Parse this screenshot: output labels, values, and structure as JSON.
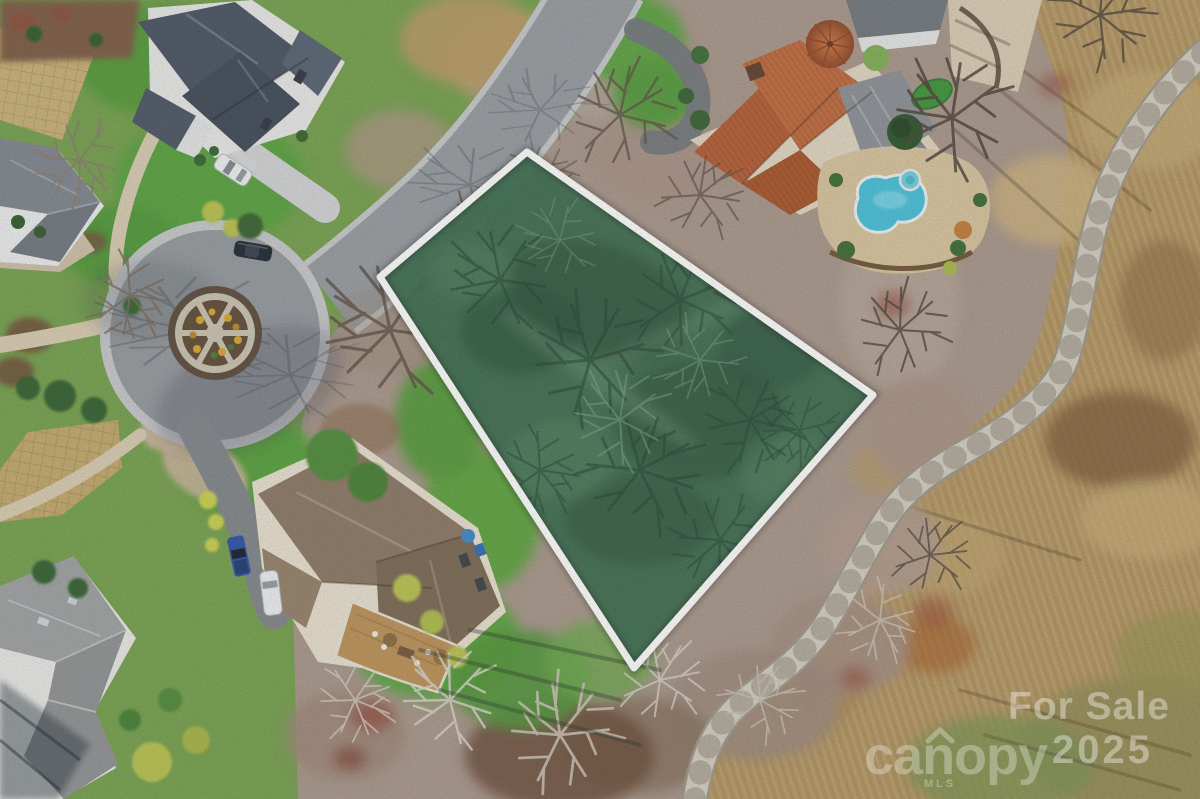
{
  "meta": {
    "type": "aerial-drone-real-estate-photo",
    "description": "Overhead aerial photo of a vacant residential lot highlighted in green with a white boundary outline, located on a cul-de-sac street beside a golf course fairway with a winding cart path. Surrounding homes include a slate-roof house (top left), a terracotta tile-roof house with kidney-shaped pool and putting green (top right), a brown shingle-roof house with rear deck (bottom left), and a gray-roof house (bottom corner)."
  },
  "watermark": {
    "headline": "For Sale",
    "year": "2025",
    "brand": "canopy",
    "brand_sub": "MLS"
  },
  "colors": {
    "parcel_fill": "#3a6b4e",
    "parcel_outline": "#ffffff",
    "pool_water": "#45c0da",
    "golf_turf": "#b3945f",
    "cart_path": "#d4cec1",
    "asphalt": "#94999e",
    "curb": "#c6c8ca",
    "lawn_green": "#5aa03c",
    "leaf_litter": "#a8968a",
    "terracotta_roof": "#b65c33",
    "slate_roof": "#475160",
    "brown_roof": "#8b7763",
    "gray_roof": "#9ea0a2",
    "deck_wood": "#bb9156",
    "island_mulch": "#5f4a36",
    "flower_yellow": "#d7a62b",
    "pickup_blue": "#2b50a8",
    "watermark_white": "#ffffff"
  },
  "scene": {
    "features": [
      "highlighted-vacant-lot-outlined-white",
      "cul-de-sac-with-landscaped-island",
      "slate-roof-house-top-left",
      "terracotta-roof-house-with-pool-top-right",
      "kidney-shaped-swimming-pool-and-hot-tub",
      "backyard-putting-green",
      "brown-roof-house-with-deck-bottom-left",
      "gray-roof-house-bottom-corner",
      "golf-course-fairway-right-side",
      "winding-concrete-cart-path",
      "bare-winter-trees-and-leaf-litter",
      "white-sedan",
      "black-sedan",
      "blue-pickup-truck",
      "white-van"
    ]
  }
}
